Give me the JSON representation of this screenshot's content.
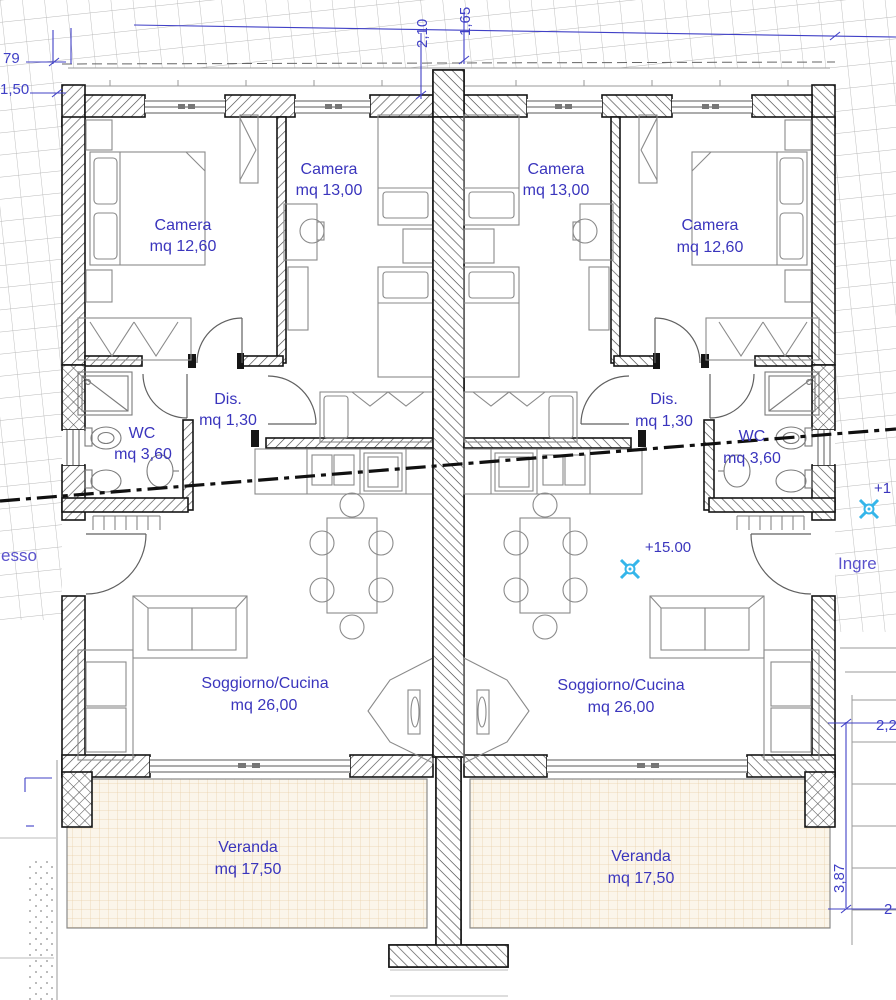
{
  "rooms": {
    "camera_left_small": {
      "name": "Camera",
      "area": "mq 12,60"
    },
    "camera_left_large": {
      "name": "Camera",
      "area": "mq 13,00"
    },
    "camera_right_large": {
      "name": "Camera",
      "area": "mq 13,00"
    },
    "camera_right_small": {
      "name": "Camera",
      "area": "mq 12,60"
    },
    "dis_left": {
      "name": "Dis.",
      "area": "mq 1,30"
    },
    "dis_right": {
      "name": "Dis.",
      "area": "mq 1,30"
    },
    "wc_left": {
      "name": "WC",
      "area": "mq 3,60"
    },
    "wc_right": {
      "name": "WC",
      "area": "mq 3,60"
    },
    "soggiorno_left": {
      "name": "Soggiorno/Cucina",
      "area": "mq 26,00"
    },
    "soggiorno_right": {
      "name": "Soggiorno/Cucina",
      "area": "mq 26,00"
    },
    "veranda_left": {
      "name": "Veranda",
      "area": "mq 17,50"
    },
    "veranda_right": {
      "name": "Veranda",
      "area": "mq 17,50"
    }
  },
  "annotations": {
    "level": "+15.00",
    "level_partial_right": "+1",
    "entrance_partial_left": "esso",
    "entrance_partial_right": "Ingre"
  },
  "dimensions": {
    "top_left_upper": "79",
    "top_left_lower": "1,50",
    "top_center_left": "2,10",
    "top_center_right": "1,65",
    "right_upper_partial": "2,2",
    "right_vertical": "3,87",
    "bottom_right_partial": "2"
  },
  "colors": {
    "label_blue": "#3a35bd",
    "dimension_blue": "#4040c6",
    "survey_cyan": "#35b6ea",
    "veranda_tile": "#e8cda6",
    "wall_hatch": "#4a4a4a",
    "site_grid": "#b9b9b9"
  }
}
